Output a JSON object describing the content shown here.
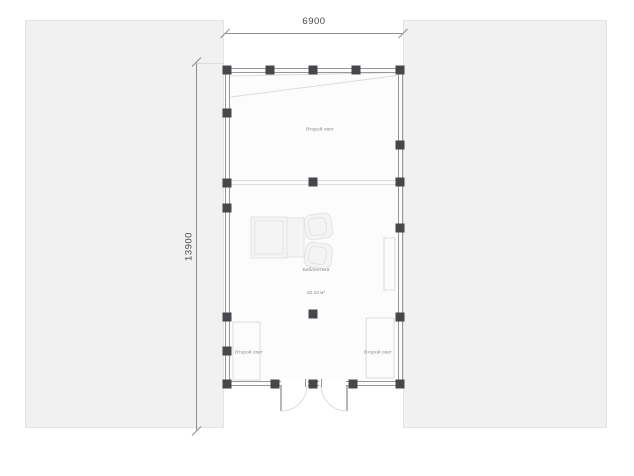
{
  "dimensions": {
    "width_label": "6900",
    "height_label": "13900"
  },
  "labels": {
    "void_top": "Второй свет",
    "room_name": "Библиотека",
    "room_area": "62.10 м²",
    "void_left": "Второй свет",
    "void_right": "Второй свет"
  },
  "colors": {
    "background": "#ffffff",
    "panel": "#f1f1f2",
    "panel_edge": "#e4e4e5",
    "wall": "#97979b",
    "column": "#47474b",
    "faint": "#dcdcde",
    "furniture": "#e3e3e5",
    "furniture_fill": "#f4f4f5",
    "dim_line": "#8f8f93",
    "dim_text": "#4a4a4a",
    "room_text": "#8a8a8a",
    "floor_fill": "#fcfcfc"
  }
}
